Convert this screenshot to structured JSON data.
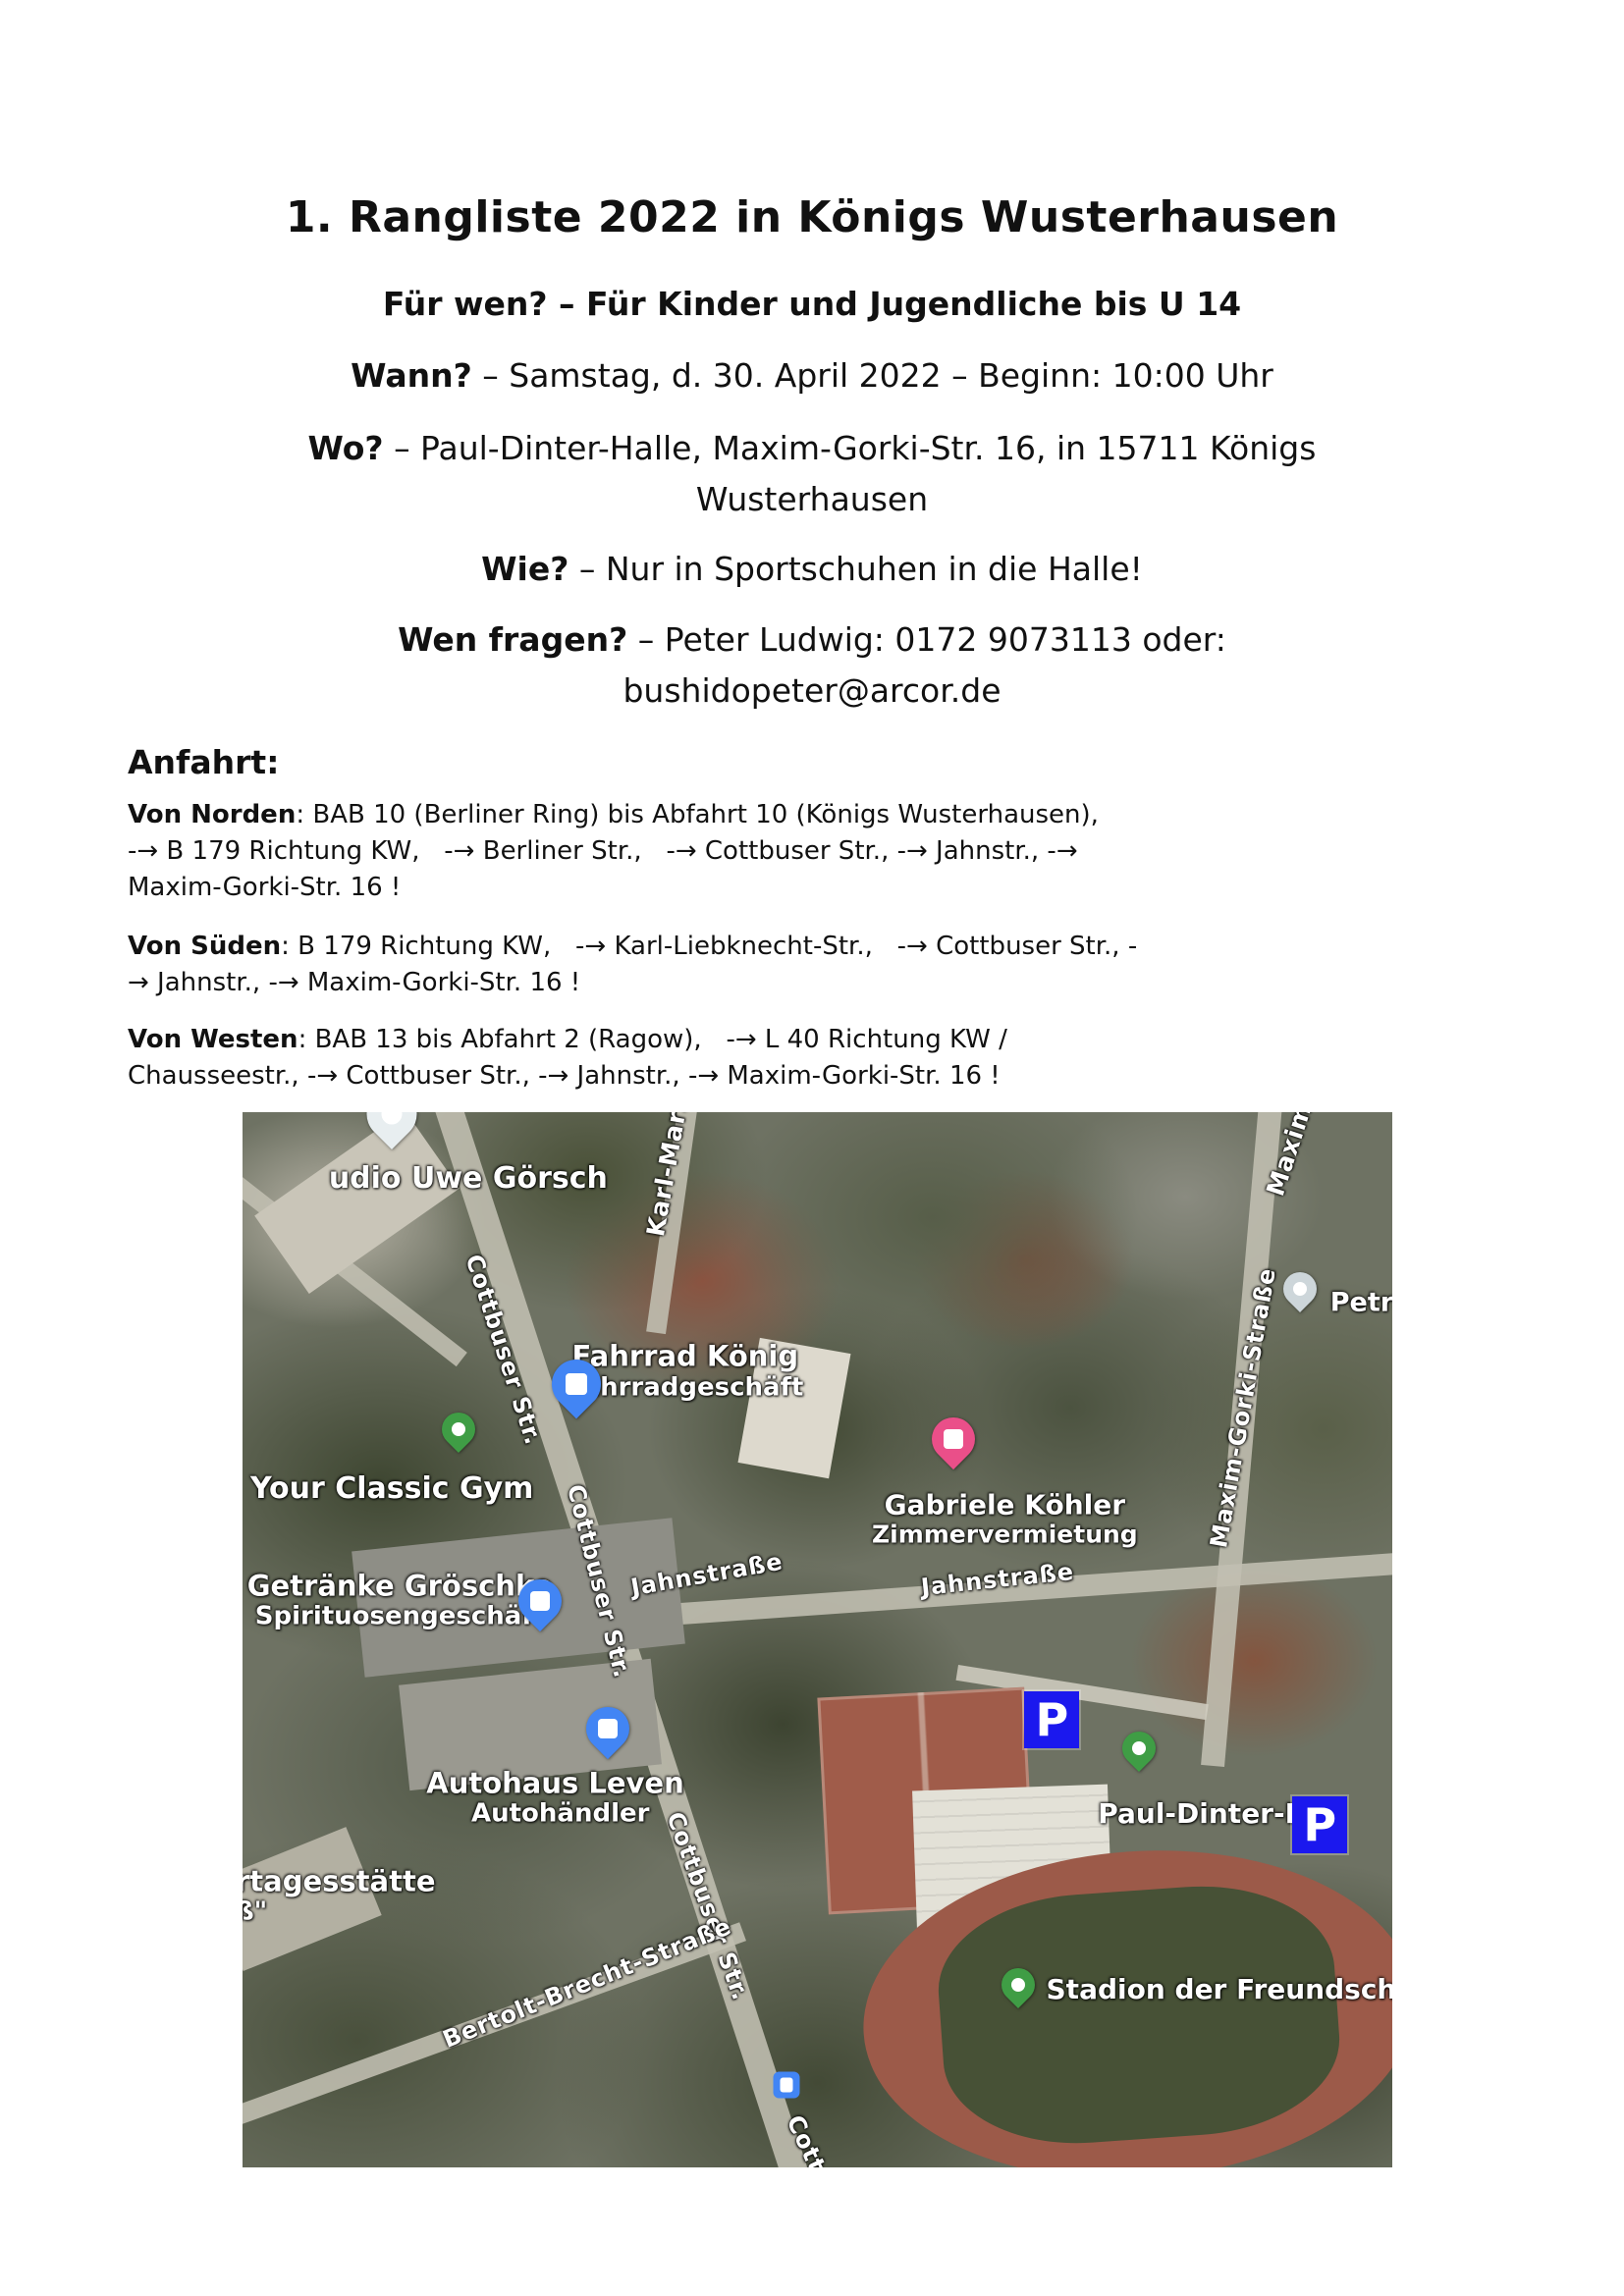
{
  "header": {
    "title": "1. Rangliste 2022 in Königs Wusterhausen",
    "audience_line": "Für wen? – Für Kinder und Jugendliche bis U 14",
    "when_label": "Wann?",
    "when_text": " – Samstag, d. 30. April 2022 – Beginn: 10:00 Uhr",
    "where_label": "Wo?",
    "where_text": " – Paul-Dinter-Halle, Maxim-Gorki-Str. 16, in 15711 Königs",
    "where_text_line2": "Wusterhausen",
    "how_label": "Wie?",
    "how_text": " – Nur in Sportschuhen in die Halle!",
    "contact_label": "Wen fragen?",
    "contact_text": " – Peter Ludwig: 0172 9073113 oder:",
    "contact_email": "bushidopeter@arcor.de"
  },
  "anfahrt": {
    "heading": "Anfahrt:",
    "routes": [
      {
        "label": "Von Norden",
        "lines": [
          ": BAB 10 (Berliner Ring) bis Abfahrt 10 (Königs Wusterhausen),",
          "-→ B 179 Richtung KW,   -→ Berliner Str.,   -→ Cottbuser Str., -→ Jahnstr., -→",
          "Maxim-Gorki-Str. 16 !"
        ]
      },
      {
        "label": "Von Süden",
        "lines": [
          ": B 179 Richtung KW,   -→ Karl-Liebknecht-Str.,   -→ Cottbuser Str., -",
          "→ Jahnstr., -→ Maxim-Gorki-Str. 16 !"
        ]
      },
      {
        "label": "Von Westen",
        "lines": [
          ": BAB 13 bis Abfahrt 2 (Ragow),   -→ L 40 Richtung KW /",
          "Chausseestr., -→ Cottbuser Str., -→ Jahnstr., -→ Maxim-Gorki-Str. 16 !"
        ]
      }
    ]
  },
  "map": {
    "type": "satellite",
    "colors": {
      "pin_green": "#3f9d45",
      "marker_blue": "#4285f4",
      "pin_pink": "#ea4f89",
      "pin_grey": "#cdd6da",
      "pin_white": "#e8eef0",
      "parking_blue": "#1b18ee",
      "bus_blue": "#4285f4"
    },
    "street_labels": [
      {
        "text": "Karl-Marx",
        "x": 37.0,
        "y": 5.0,
        "rotate": -80,
        "size": 25
      },
      {
        "text": "Maxim",
        "x": 91.0,
        "y": 3.5,
        "rotate": -72,
        "size": 25
      },
      {
        "text": "Maxim-Gorki-Straße",
        "x": 87.0,
        "y": 28.0,
        "rotate": -80,
        "size": 24
      },
      {
        "text": "Cottbuser Str.",
        "x": 22.7,
        "y": 22.5,
        "rotate": 72,
        "size": 24
      },
      {
        "text": "Cottbuser Str.",
        "x": 31.0,
        "y": 44.5,
        "rotate": 76,
        "size": 24
      },
      {
        "text": "Jahnstraße",
        "x": 40.4,
        "y": 43.8,
        "rotate": -10,
        "size": 24
      },
      {
        "text": "Jahnstraße",
        "x": 65.7,
        "y": 44.3,
        "rotate": -6,
        "size": 24
      },
      {
        "text": "Cottbuser Str.",
        "x": 40.5,
        "y": 75.3,
        "rotate": 70,
        "size": 24
      },
      {
        "text": "Bertolt-Brecht-Straße",
        "x": 30.0,
        "y": 82.5,
        "rotate": -22,
        "size": 24
      },
      {
        "text": "Cott",
        "x": 49.0,
        "y": 97.8,
        "rotate": 65,
        "size": 24
      }
    ],
    "poi_labels": [
      {
        "text": "udio Uwe Görsch",
        "x": 7.5,
        "y": 6.3,
        "size": 30,
        "align": "left_cut"
      },
      {
        "text": "Fahrrad König",
        "x": 38.5,
        "y": 24.6,
        "size": 29,
        "sub": "Fahrradgeschäft"
      },
      {
        "text": "Your Classic Gym",
        "x": 13.0,
        "y": 35.7,
        "size": 30
      },
      {
        "text": "Petral",
        "x": 94.6,
        "y": 18.0,
        "size": 27,
        "align": "left_cut"
      },
      {
        "text": "Gabriele Köhler",
        "x": 66.3,
        "y": 38.6,
        "size": 28,
        "sub": "Zimmervermietung"
      },
      {
        "text": "Getränke Gröschke",
        "x": 13.7,
        "y": 46.3,
        "size": 29,
        "sub": "Spirituosengeschäft"
      },
      {
        "text": "Autohaus Leven",
        "x": 27.2,
        "y": 65.0,
        "size": 29,
        "sub": "Autohändler",
        "sub_dx": 4.0
      },
      {
        "text": "Paul-Dinter-Hall",
        "x": 74.4,
        "y": 66.5,
        "size": 28,
        "align": "left_cut"
      },
      {
        "text": "Stadion der Freundschaft",
        "x": 69.9,
        "y": 83.2,
        "size": 28,
        "align": "left_cut"
      },
      {
        "text": "rtagesstätte",
        "x": -0.6,
        "y": 74.3,
        "size": 29,
        "sub": "ß\"",
        "align": "left_cut"
      }
    ],
    "markers": [
      {
        "id": "studio-pin",
        "type": "pin",
        "color": "#e8eef0",
        "x": 13.0,
        "y": 0.2,
        "scale": 1.5
      },
      {
        "id": "fahrrad-koenig-marker",
        "type": "shop",
        "color": "#4285f4",
        "x": 29.0,
        "y": 25.8,
        "scale": 1.25
      },
      {
        "id": "your-classic-gym-pin",
        "type": "pin",
        "color": "#3f9d45",
        "x": 18.8,
        "y": 30.0,
        "scale": 1.0
      },
      {
        "id": "petral-pin",
        "type": "pin",
        "color": "#cdd6da",
        "x": 92.0,
        "y": 16.7,
        "scale": 1.0
      },
      {
        "id": "gabriele-koehler-marker",
        "type": "shop",
        "color": "#ea4f89",
        "x": 61.8,
        "y": 31.0,
        "scale": 1.1
      },
      {
        "id": "getraenke-marker",
        "type": "shop",
        "color": "#4285f4",
        "x": 25.9,
        "y": 46.3,
        "scale": 1.1
      },
      {
        "id": "autohaus-marker",
        "type": "shop",
        "color": "#4285f4",
        "x": 31.8,
        "y": 58.4,
        "scale": 1.1
      },
      {
        "id": "paul-dinter-pin",
        "type": "pin",
        "color": "#3f9d45",
        "x": 78.0,
        "y": 60.3,
        "scale": 1.0
      },
      {
        "id": "stadion-pin",
        "type": "pin",
        "color": "#3f9d45",
        "x": 67.5,
        "y": 82.7,
        "scale": 1.0
      },
      {
        "id": "parking-marker-1",
        "type": "parking",
        "color": "#1b18ee",
        "label": "P",
        "x": 70.4,
        "y": 57.6
      },
      {
        "id": "parking-marker-2",
        "type": "parking",
        "color": "#1b18ee",
        "label": "P",
        "x": 93.7,
        "y": 67.5
      },
      {
        "id": "bus-stop-icon",
        "type": "bus",
        "color": "#4285f4",
        "x": 47.3,
        "y": 92.2
      }
    ]
  }
}
